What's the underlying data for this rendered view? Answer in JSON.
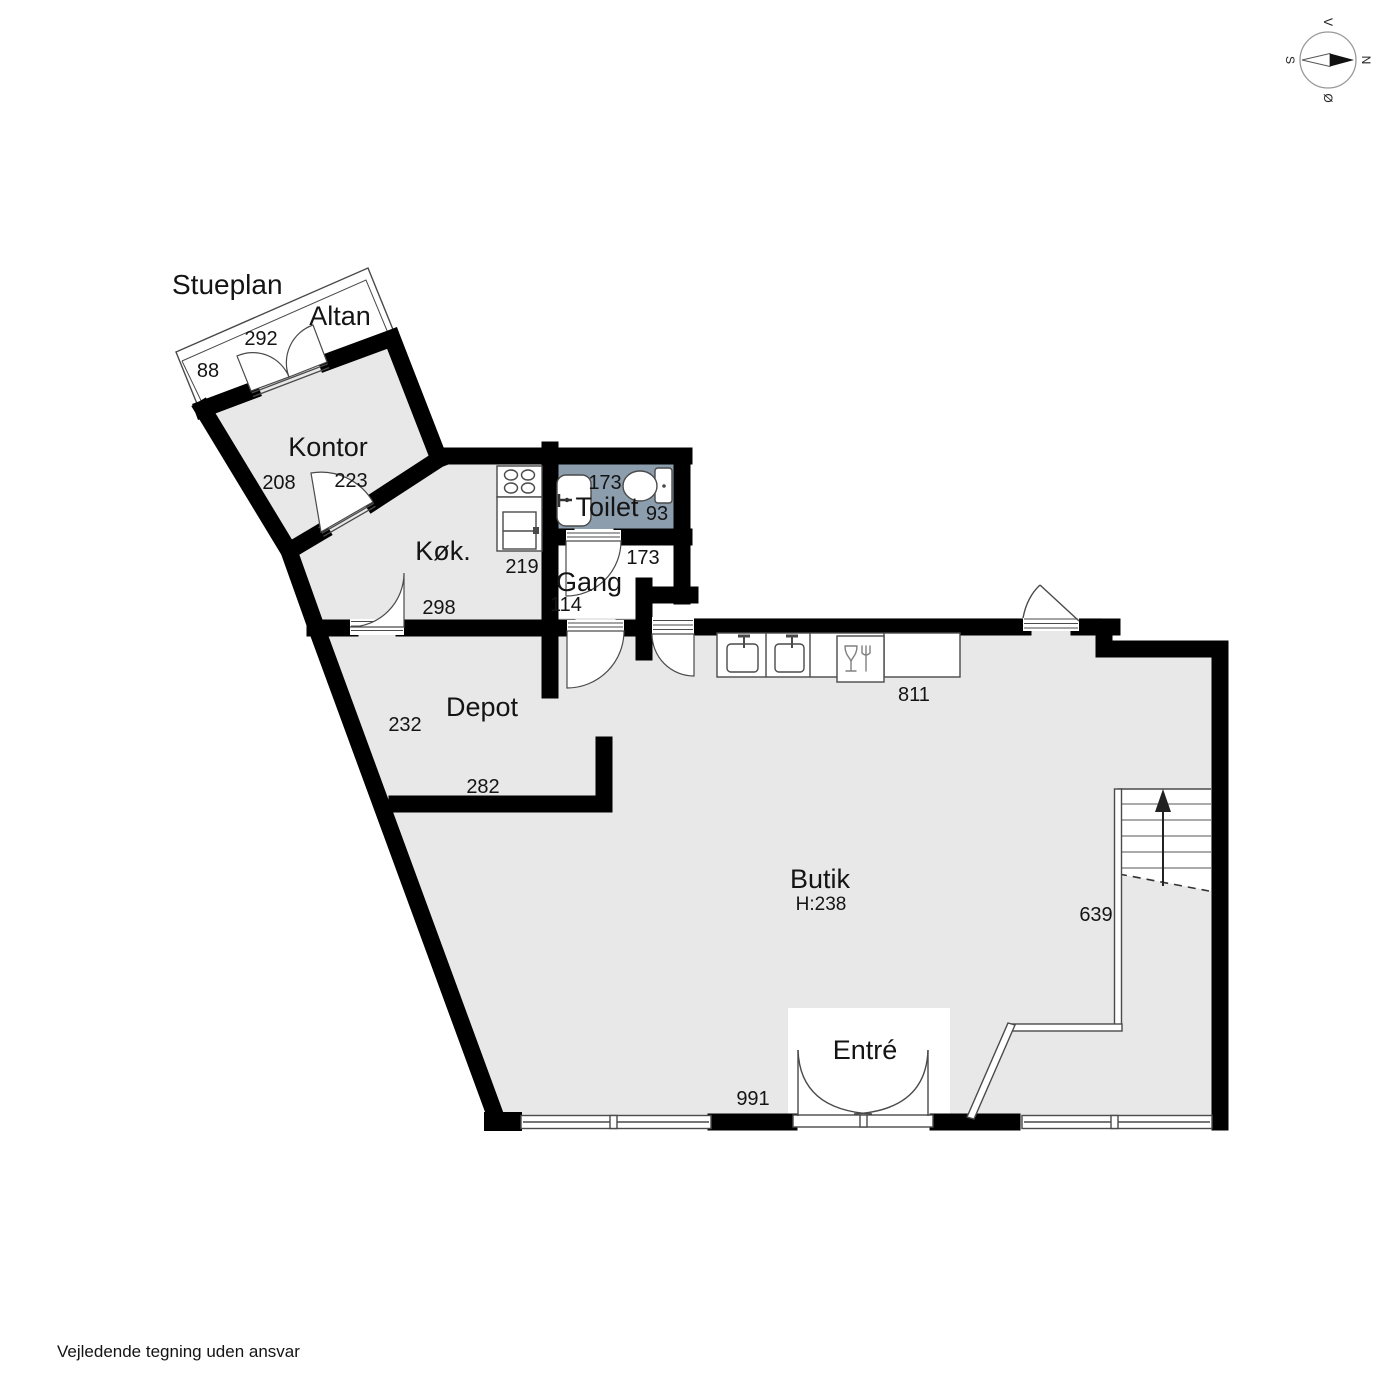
{
  "title": "Stueplan",
  "disclaimer": "Vejledende tegning uden ansvar",
  "compass": {
    "west": "V",
    "north": "N",
    "east": "Ø",
    "south": "S"
  },
  "colors": {
    "floor": "#e8e8e8",
    "wet_room": "#8c9ead",
    "wall": "#000000",
    "outline": "#4a4a4a"
  },
  "rooms": {
    "altan": {
      "label": "Altan",
      "width": "292",
      "depth": "88"
    },
    "kontor": {
      "label": "Kontor",
      "dim_a": "208",
      "dim_b": "223"
    },
    "kok": {
      "label": "Køk.",
      "dim_a": "219",
      "dim_b": "298"
    },
    "toilet": {
      "label": "Toilet",
      "dim_a": "173",
      "dim_b": "93"
    },
    "gang": {
      "label": "Gang",
      "dim_a": "114",
      "dim_b": "173"
    },
    "depot": {
      "label": "Depot",
      "dim_a": "232",
      "dim_b": "282"
    },
    "butik": {
      "label": "Butik",
      "height_note": "H:238",
      "dim_a": "811",
      "dim_b": "639",
      "dim_c": "991"
    },
    "entre": {
      "label": "Entré"
    }
  }
}
